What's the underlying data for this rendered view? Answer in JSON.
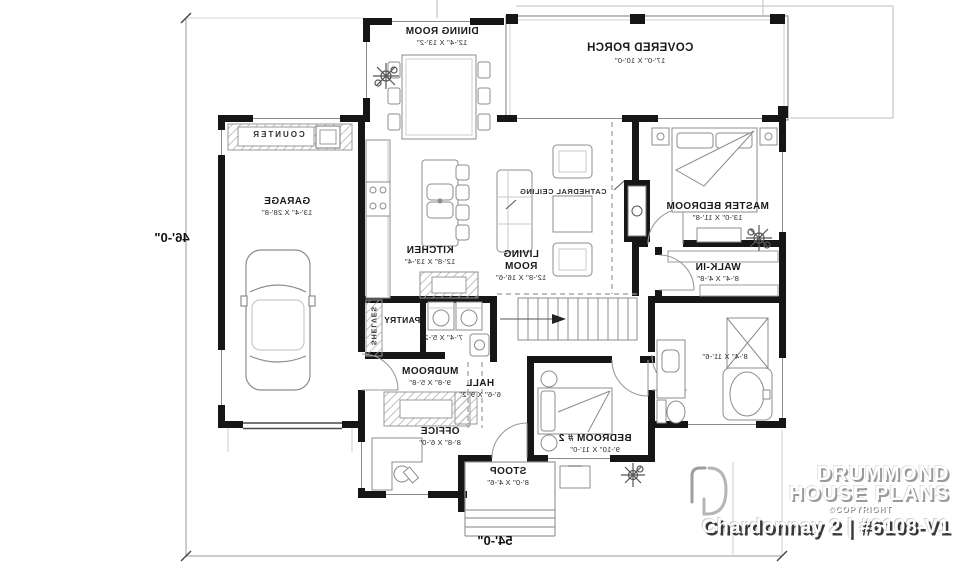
{
  "plan": {
    "rooms": [
      {
        "name": "DINING ROOM",
        "dims": "12'-4\" X 13'-2\""
      },
      {
        "name": "COVERED PORCH",
        "dims": "17'-0\" X 10'-0\""
      },
      {
        "name": "GARAGE",
        "dims": "13'-4\" X 28'-8\""
      },
      {
        "name": "KITCHEN",
        "dims": "12'-8\" X 13'-4\""
      },
      {
        "name": "LIVING ROOM",
        "dims": "12'-8\" X 16'-6\""
      },
      {
        "name": "MASTER BEDROOM",
        "dims": "13'-0\" X 11'-8\""
      },
      {
        "name": "WALK-IN",
        "dims": "8'-4\" X 4'-8\""
      },
      {
        "dims": "8'-4\" X 11'-6\""
      },
      {
        "name": "PANTRY",
        "dims": "7'-4\" X 5'-2\""
      },
      {
        "name": "MUDROOM",
        "dims": "9'-8\" X 5'-8\""
      },
      {
        "name": "HALL",
        "dims": "6'-6\" X 9'-2\""
      },
      {
        "name": "OFFICE",
        "dims": "8'-8\" X 6'-0\""
      },
      {
        "name": "STOOP",
        "dims": "8'-0\" X 4'-6\""
      },
      {
        "name": "BEDROOM # 2",
        "dims": "9'-10\" X 11'-0\""
      }
    ],
    "annotations": {
      "cathedral_ceiling": "CATHEDRAL CEILING",
      "counter": "COUNTER",
      "shelves": "SHELVES"
    },
    "dimensions": {
      "width": "54'-0\"",
      "height": "46'-0\""
    }
  },
  "branding": {
    "brand_line1": "DRUMMOND",
    "brand_line2": "HOUSE PLANS",
    "copyright": "©COPYRIGHT",
    "plan_title": "Chardonnay 2 | #6108-V1"
  }
}
